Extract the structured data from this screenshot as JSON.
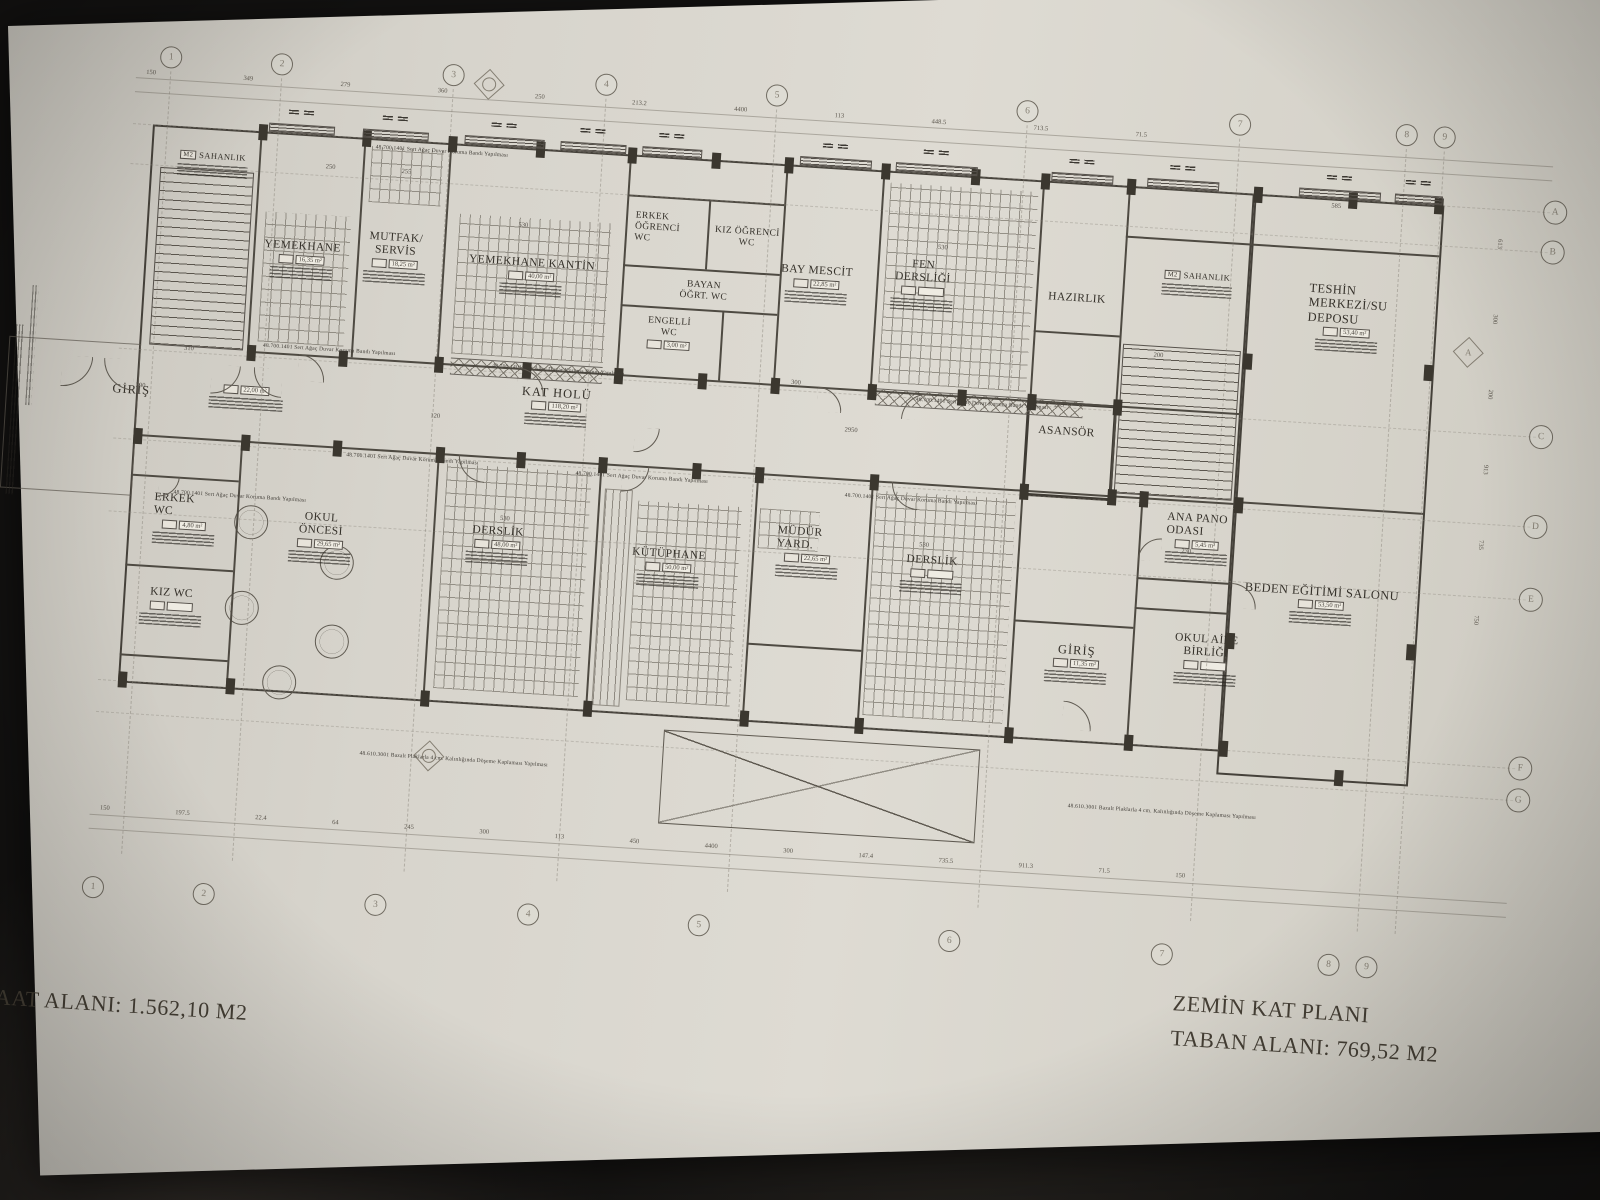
{
  "title_block": {
    "plan_title": "ZEMİN KAT PLANI",
    "taban_alani": "TABAN ALANI: 769,52 M2",
    "insaat_alani": "İNŞAAT ALANI: 1.562,10 M2"
  },
  "grid": {
    "top": [
      "1",
      "2",
      "3",
      "4",
      "5",
      "6",
      "7",
      "8",
      "9"
    ],
    "bottom": [
      "1",
      "2",
      "3",
      "4",
      "5",
      "6",
      "7",
      "8",
      "9"
    ],
    "right": [
      "A",
      "B",
      "C",
      "D",
      "E",
      "F",
      "G"
    ],
    "section_marker": "A"
  },
  "rooms": [
    {
      "name": "SAHANLIK",
      "tag": "M2",
      "area": ""
    },
    {
      "name": "YEMEKHANE",
      "area": "16,35 m²"
    },
    {
      "name": "MUTFAK/\nSERVİS",
      "area": "18,25 m²"
    },
    {
      "name": "YEMEKHANE KANTİN",
      "area": "40,00 m²"
    },
    {
      "name": "ERKEK\nÖĞRENCİ\nWC",
      "area": ""
    },
    {
      "name": "KIZ ÖĞRENCİ\nWC",
      "area": ""
    },
    {
      "name": "BAYAN\nÖĞRT. WC",
      "area": ""
    },
    {
      "name": "ENGELLİ\nWC",
      "area": "3,00 m²"
    },
    {
      "name": "BAY MESCİT",
      "area": "22,85 m²"
    },
    {
      "name": "FEN\nDERSLİĞİ",
      "area": ""
    },
    {
      "name": "HAZIRLIK",
      "area": ""
    },
    {
      "name": "ASANSÖR",
      "area": ""
    },
    {
      "name": "SAHANLIK",
      "tag": "M2",
      "area": ""
    },
    {
      "name": "TESHİN\nMERKEZİ/SU\nDEPOSU",
      "area": "53,40 m²"
    },
    {
      "name": "KAT HOLÜ",
      "area": "118,20 m²"
    },
    {
      "name": "GİRİŞ",
      "area": "22,00 m²"
    },
    {
      "name": "ERKEK\nWC",
      "area": "4,80 m²"
    },
    {
      "name": "KIZ WC",
      "area": ""
    },
    {
      "name": "OKUL\nÖNCESİ",
      "area": "29,65 m²"
    },
    {
      "name": "DERSLİK",
      "area": "48,00 m²"
    },
    {
      "name": "KÜTÜPHANE",
      "area": "50,00 m²"
    },
    {
      "name": "MÜDÜR\nYARD.",
      "area": "22,65 m²"
    },
    {
      "name": "DERSLİK",
      "area": ""
    },
    {
      "name": "GİRİŞ",
      "area": "11,35 m²"
    },
    {
      "name": "ANA PANO\nODASI",
      "area": "5,45 m²"
    },
    {
      "name": "OKUL AİLE\nBİRLİĞİ",
      "area": ""
    },
    {
      "name": "BEDEN EĞİTİMİ SALONU",
      "area": "53,50 m²"
    }
  ],
  "notes": {
    "wall_band": "48.700.1401 Sert Ağaç Duvar Koruma Bandı Yapılması",
    "floor": "48.610.3001 Bazalt Plaklarla 4 cm. Kalınlığında Döşeme Kaplaması Yapılması"
  },
  "dims": {
    "top_row": "150 349 279 360 250 213.2 4400 113 448.5 713.5 71.5",
    "bottom_row": "150 197.5 22.4 64 245 300 113 450 4400 300 147.4 735.5 911.3 71.5 150",
    "right_col": "613 300 200 913 735 750",
    "misc": [
      "250",
      "255",
      "530",
      "530",
      "300",
      "310",
      "2950",
      "265",
      "530",
      "530",
      "120",
      "200",
      "585",
      "230",
      "300"
    ]
  },
  "colors": {
    "paper": "#d9d6cd",
    "ink": "#56514a",
    "background": "#141312"
  }
}
